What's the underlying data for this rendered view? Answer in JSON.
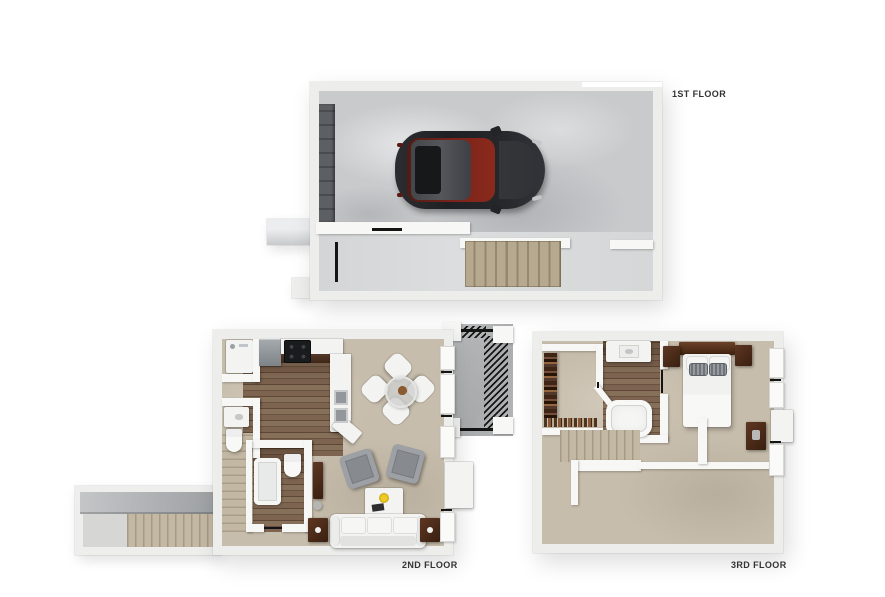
{
  "image_type": "3d-floor-plan-rendering",
  "floors": [
    {
      "id": "first-floor",
      "label": "1ST FLOOR",
      "rooms": [
        "garage",
        "entry-hall",
        "staircase",
        "front-porch"
      ],
      "objects": [
        "parked-car",
        "garage-door",
        "interior-door-markers",
        "carpeted-stairs"
      ]
    },
    {
      "id": "second-floor",
      "label": "2ND FLOOR",
      "rooms": [
        "kitchen",
        "dining-area",
        "living-room",
        "bathroom",
        "laundry-closet",
        "stair-hall",
        "balcony-deck"
      ],
      "objects": [
        "washer",
        "refrigerator",
        "range-cooktop",
        "double-sink-counter",
        "half-bath-sink",
        "toilet",
        "bathtub",
        "round-dining-table",
        "four-white-chairs",
        "two-gray-armchairs",
        "coffee-table",
        "white-sofa",
        "end-tables-with-lamps",
        "media-console",
        "deck-railing"
      ]
    },
    {
      "id": "third-floor",
      "label": "3RD FLOOR",
      "rooms": [
        "walk-in-closet",
        "bathroom",
        "bedroom",
        "open-loft",
        "staircase"
      ],
      "objects": [
        "hanging-clothes",
        "shoe-row",
        "vanity-sink",
        "oval-bathtub",
        "bed-with-headboard",
        "nightstands",
        "dresser",
        "stair-railing"
      ]
    }
  ],
  "colors": {
    "background": "#ffffff",
    "walls": "#ededec",
    "garage_floor": "#c8cacc",
    "carpet": "#c7bdac",
    "wood_floor": "#77604d",
    "deck_floor": "#b4b6b8",
    "stair_carpet": "#b6a98f",
    "car_body": "#26272b",
    "car_interior_red": "#7c231a",
    "dark_wood_furniture": "#4a2a1a",
    "appliance_gray": "#9aa0a5",
    "label_text": "#333333"
  }
}
